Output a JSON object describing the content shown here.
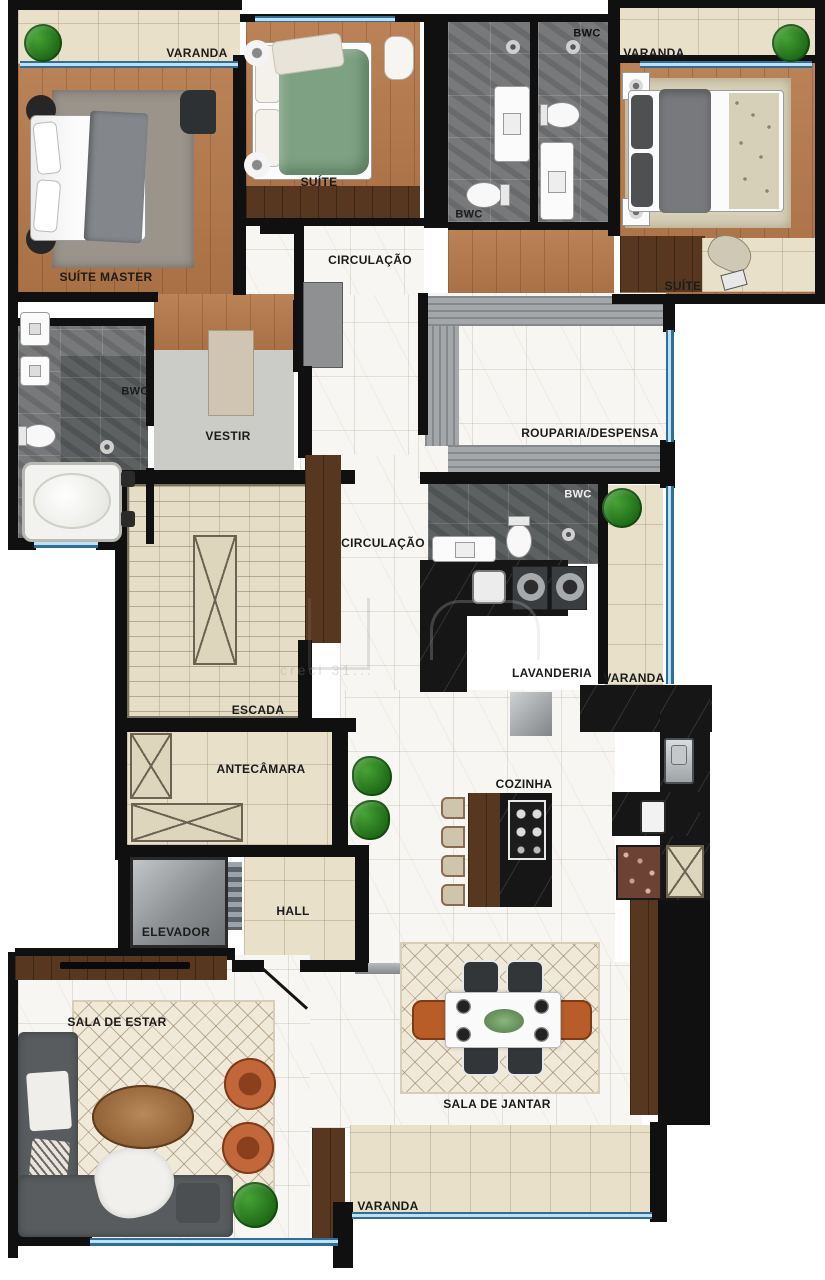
{
  "plan_title": "Planta baixa de apartamento",
  "rooms": {
    "varanda_tl": {
      "label": "VARANDA"
    },
    "suite_master": {
      "label": "SUÍTE MASTER"
    },
    "suite_2": {
      "label": "SUÍTE"
    },
    "circulacao_1": {
      "label": "CIRCULAÇÃO"
    },
    "bwc_1": {
      "label": "BWC"
    },
    "varanda_tr": {
      "label": "VARANDA"
    },
    "bwc_2": {
      "label": "BWC"
    },
    "suite_3": {
      "label": "SUÍTE"
    },
    "bwc_master": {
      "label": "BWC"
    },
    "vestir": {
      "label": "VESTIR"
    },
    "rouparia": {
      "label": "ROUPARIA/DESPENSA"
    },
    "circulacao_2": {
      "label": "CIRCULAÇÃO"
    },
    "bwc_3": {
      "label": "BWC"
    },
    "varanda_right": {
      "label": "VARANDA"
    },
    "lavanderia": {
      "label": "LAVANDERIA"
    },
    "escada": {
      "label": "ESCADA"
    },
    "antecamara": {
      "label": "ANTECÂMARA"
    },
    "cozinha": {
      "label": "COZINHA"
    },
    "hall": {
      "label": "HALL"
    },
    "elevador": {
      "label": "ELEVADOR"
    },
    "sala_estar": {
      "label": "SALA DE ESTAR"
    },
    "sala_jantar": {
      "label": "SALA DE JANTAR"
    },
    "varanda_b": {
      "label": "VARANDA"
    }
  },
  "watermark": {
    "text": "creci 31..."
  },
  "colors": {
    "wall": "#101010",
    "wood_floor": "#b5794a",
    "dark_wood": "#57371f",
    "marble": "#f8f6f2",
    "beige_tile": "#e9e0ca",
    "gray_tile": "#77797b",
    "black_counter": "#161616",
    "glass_blue": "#2f6f97",
    "plant_green": "#2c7d22",
    "accent_orange": "#c2673a",
    "label_text": "#1b1b1b"
  }
}
